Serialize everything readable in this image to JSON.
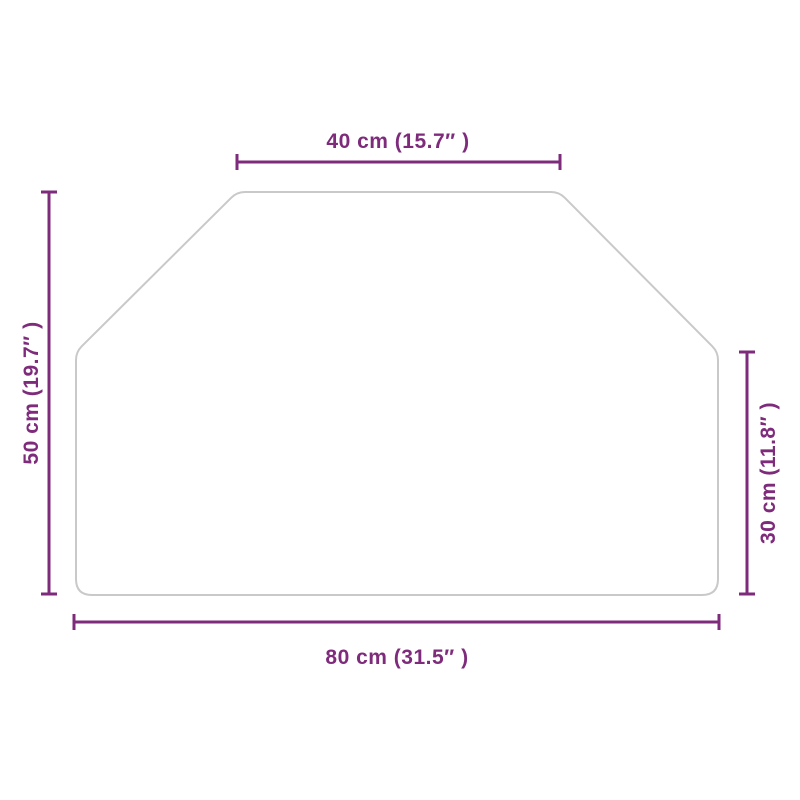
{
  "diagram": {
    "shape": "hexagon-panel",
    "dimensions": {
      "top": "40 cm (15.7″ )",
      "bottom": "80 cm (31.5″ )",
      "left": "50 cm (19.7″ )",
      "right": "30 cm (11.8″ )"
    }
  },
  "colors": {
    "dimension_accent": "#7E2B7B",
    "shape_outline": "#C9C9C9",
    "background": "#FFFFFF"
  }
}
